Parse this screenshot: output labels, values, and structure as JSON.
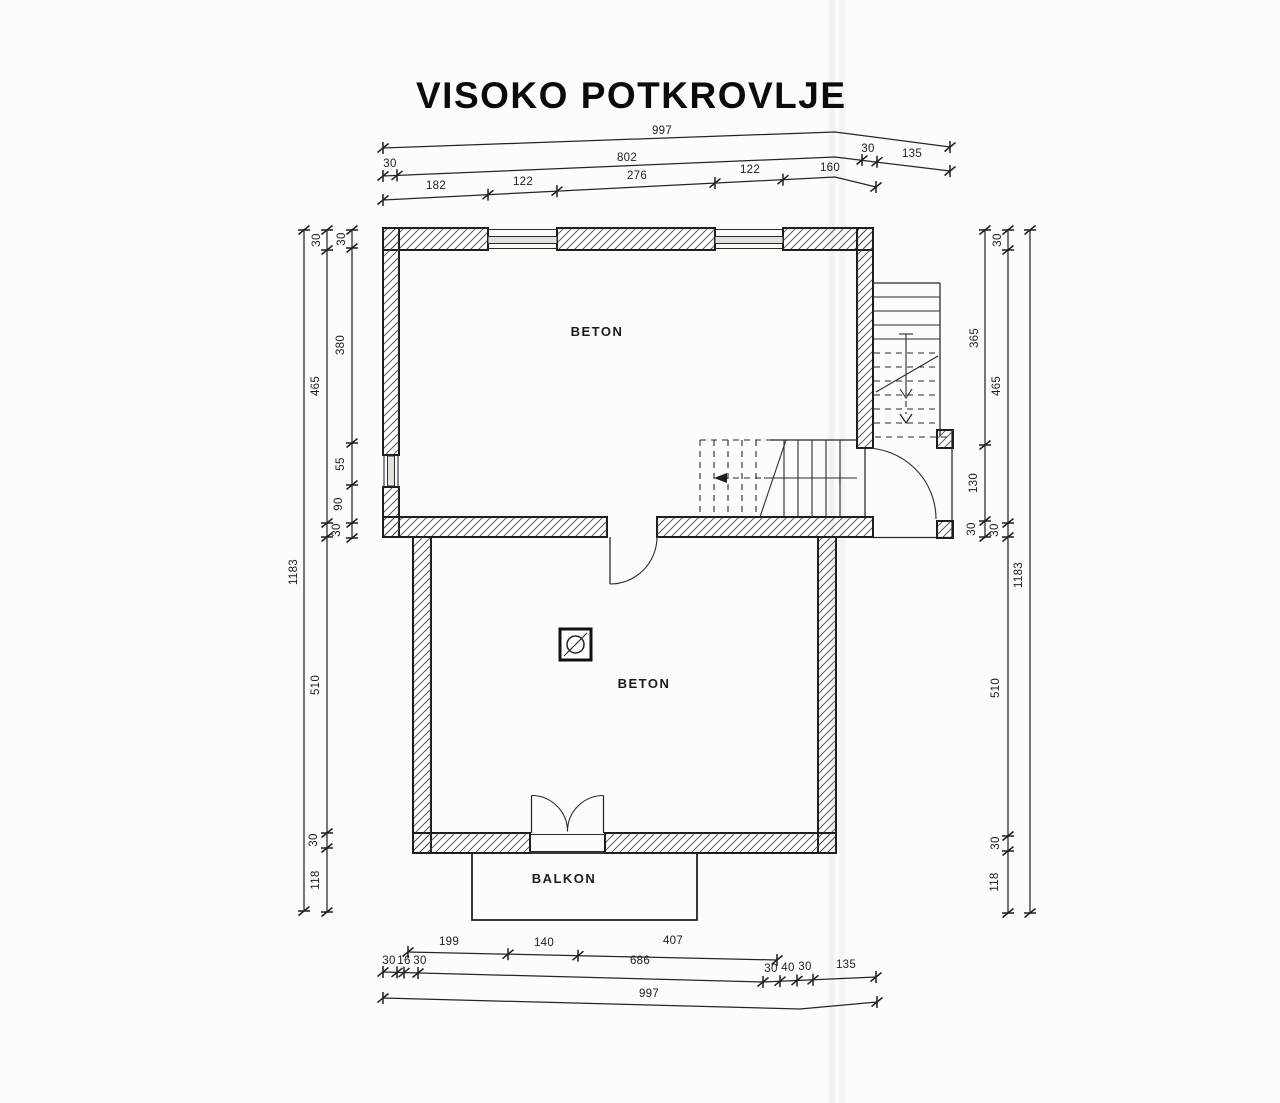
{
  "title": "VISOKO POTKROVLJE",
  "rooms": {
    "upper_label": "BETON",
    "lower_label": "BETON",
    "balcony_label": "BALKON"
  },
  "dims": {
    "top": {
      "total": "997",
      "row2": [
        "30",
        "802",
        "30",
        "135"
      ],
      "row3": [
        "182",
        "122",
        "276",
        "122",
        "160"
      ]
    },
    "bottom": {
      "row1": [
        "199",
        "140",
        "407"
      ],
      "row2": [
        "30",
        "16",
        "30",
        "686",
        "30",
        "40",
        "30",
        "135"
      ],
      "total": "997"
    },
    "left": {
      "outer_total": "1183",
      "middle": [
        "30",
        "465",
        "510",
        "30",
        "118"
      ],
      "inner": [
        "30",
        "380",
        "55",
        "90",
        "30"
      ]
    },
    "right": {
      "outer_total": "1183",
      "inner": [
        "365",
        "130",
        "30"
      ],
      "middle": [
        "30",
        "465",
        "30",
        "510",
        "30",
        "118"
      ]
    }
  },
  "colors": {
    "ink": "#222222",
    "paper": "#fcfcfa"
  }
}
